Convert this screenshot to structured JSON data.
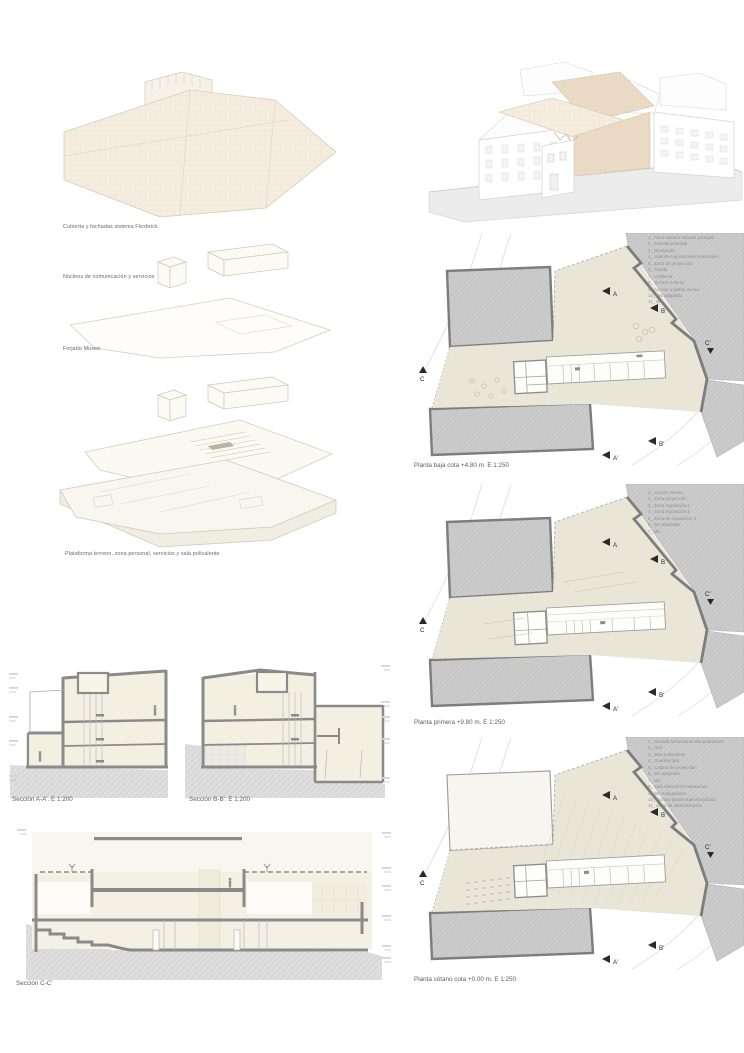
{
  "exploded_axon": {
    "labels": [
      "Cubierta y fachadas sistema Flexbrick",
      "Núcleos de comunicación y servicios",
      "Forjado Museo",
      "Plataforma terreno, zona personal, servicios y sala polivalente"
    ]
  },
  "markers": {
    "a": "A",
    "b": "B",
    "c": "C",
    "a_prime": "A'",
    "b_prime": "B'",
    "c_prime": "C'"
  },
  "plans": [
    {
      "caption": "Planta baja cota +4.80 m. E 1:250",
      "legend": [
        "1_ Patio exterior entrada principal",
        "2_ Entrada principal",
        "3_ Recepción",
        "4_ Sala de exposiciones temporales",
        "5_ Zona de proyección",
        "6_ Tienda",
        "7_ Cafetería",
        "8_ Terraza exterior",
        "9_ Acceso a planta museo",
        "10_ Wc adaptado",
        "11_ Wc"
      ]
    },
    {
      "caption": "Planta primera +9.80 m. E 1:250",
      "legend": [
        "1_ Acceso museo",
        "2_ Zona proyección",
        "3_ Zona exposición 1",
        "4_ Zona exposición 2",
        "5_ Zona de exposición 3",
        "6_ Wc adaptado",
        "7_ Wc"
      ]
    },
    {
      "caption": "Planta sótano cota +0.00 m. E 1:250",
      "legend": [
        "1_ Entrada secundaria sala polivalente",
        "2_ Hall",
        "3_ Sala polivalente",
        "4_ Guardarropa",
        "5_ Cabina de proyección",
        "6_ Wc adaptado",
        "7_ Wc",
        "8_ Sala almacén/instalaciones",
        "9_ Wc trabajadores",
        "10_ Acceso planta superior público",
        "11_ Zona de administración"
      ]
    }
  ],
  "sections": [
    {
      "caption": "Sección A-A'. E 1:200"
    },
    {
      "caption": "Sección B-B'. E 1:200"
    },
    {
      "caption": "Sección C-C'"
    }
  ],
  "colors": {
    "site_beige": "#e9e6d8",
    "context_gray": "#cbcbcb",
    "wall_gray": "#7d7d7d",
    "flexbrick_tan": "#ecdcc8",
    "ground_gray": "#dedede",
    "caption_text": "#5e5e5e",
    "legend_text": "#8f8f8f"
  }
}
